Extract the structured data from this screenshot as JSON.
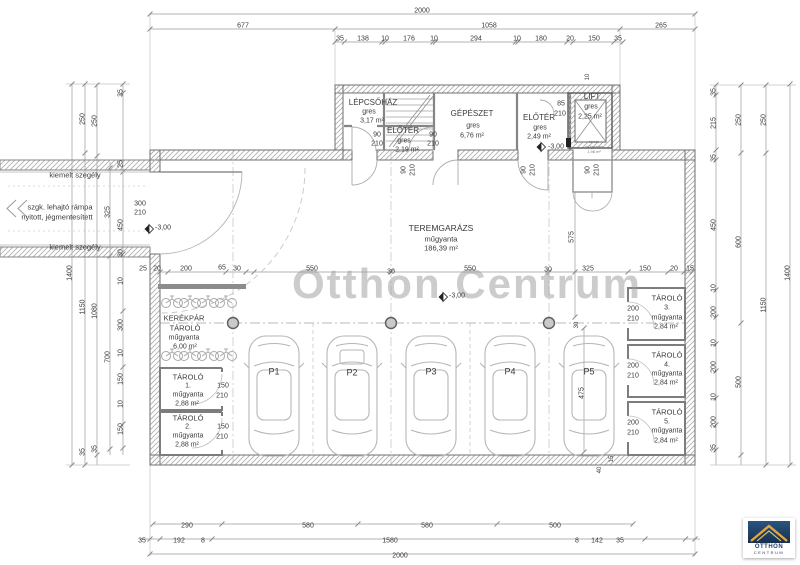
{
  "watermark": {
    "text": "Otthon Centrum",
    "color": "#9b9b9b"
  },
  "logo": {
    "line1": "OTTHON",
    "line2": "CENTRUM",
    "navy": "#1e3f66",
    "gold": "#e8a33d"
  },
  "labels": [
    {
      "t": "2000",
      "x": 422,
      "y": 11
    },
    {
      "t": "677",
      "x": 243,
      "y": 26
    },
    {
      "t": "1058",
      "x": 489,
      "y": 26
    },
    {
      "t": "265",
      "x": 661,
      "y": 26
    },
    {
      "t": "35",
      "x": 340,
      "y": 39
    },
    {
      "t": "138",
      "x": 363,
      "y": 39
    },
    {
      "t": "10",
      "x": 385,
      "y": 39
    },
    {
      "t": "176",
      "x": 409,
      "y": 39
    },
    {
      "t": "10",
      "x": 434,
      "y": 39
    },
    {
      "t": "294",
      "x": 476,
      "y": 39
    },
    {
      "t": "10",
      "x": 517,
      "y": 39
    },
    {
      "t": "180",
      "x": 541,
      "y": 39
    },
    {
      "t": "20",
      "x": 570,
      "y": 39
    },
    {
      "t": "150",
      "x": 594,
      "y": 39
    },
    {
      "t": "35",
      "x": 618,
      "y": 39
    },
    {
      "t": "LÉPCSŐHÁZ",
      "x": 373,
      "y": 103,
      "s": 8,
      "n": "room-label-lepcsohaz"
    },
    {
      "t": "gres",
      "x": 369,
      "y": 112
    },
    {
      "t": "3,17 m²",
      "x": 372,
      "y": 121
    },
    {
      "t": "90",
      "x": 377,
      "y": 135,
      "n": "door-size-label"
    },
    {
      "t": "210",
      "x": 377,
      "y": 144,
      "n": "door-size-label"
    },
    {
      "t": "ELŐTÉR",
      "x": 403,
      "y": 131,
      "s": 8,
      "n": "room-label-eloter-1"
    },
    {
      "t": "gres",
      "x": 404,
      "y": 141
    },
    {
      "t": "2,19 m²",
      "x": 407,
      "y": 150
    },
    {
      "t": "90",
      "x": 433,
      "y": 135,
      "n": "door-size-label"
    },
    {
      "t": "210",
      "x": 433,
      "y": 144,
      "n": "door-size-label"
    },
    {
      "t": "GÉPÉSZET",
      "x": 472,
      "y": 114,
      "s": 8,
      "n": "room-label-gepeszet"
    },
    {
      "t": "gres",
      "x": 473,
      "y": 126
    },
    {
      "t": "6,76 m²",
      "x": 472,
      "y": 136
    },
    {
      "t": "ELŐTÉR",
      "x": 539,
      "y": 118,
      "s": 8,
      "n": "room-label-eloter-2"
    },
    {
      "t": "gres",
      "x": 540,
      "y": 128
    },
    {
      "t": "2,49 m²",
      "x": 539,
      "y": 137
    },
    {
      "t": "-3,00",
      "x": 556,
      "y": 147,
      "n": "level-label"
    },
    {
      "t": "85",
      "x": 561,
      "y": 104,
      "n": "door-size-label"
    },
    {
      "t": "210",
      "x": 560,
      "y": 114,
      "n": "door-size-label"
    },
    {
      "t": "LIFT",
      "x": 592,
      "y": 97,
      "s": 8,
      "n": "room-label-lift"
    },
    {
      "t": "gres",
      "x": 591,
      "y": 107
    },
    {
      "t": "2,25 m²",
      "x": 590,
      "y": 117
    },
    {
      "t": "10",
      "x": 588,
      "y": 77,
      "r": -90,
      "s": 6
    },
    {
      "t": "tároló",
      "x": 594,
      "y": 142,
      "s": 4,
      "c": "#777"
    },
    {
      "t": "műgyanta",
      "x": 594,
      "y": 147,
      "s": 4,
      "c": "#777"
    },
    {
      "t": "1,98 m²",
      "x": 594,
      "y": 152,
      "s": 4,
      "c": "#777"
    },
    {
      "t": "90",
      "x": 404,
      "y": 170,
      "r": -90,
      "n": "door-size-label"
    },
    {
      "t": "210",
      "x": 413,
      "y": 170,
      "r": -90,
      "n": "door-size-label"
    },
    {
      "t": "90",
      "x": 524,
      "y": 170,
      "r": -90,
      "n": "door-size-label"
    },
    {
      "t": "210",
      "x": 533,
      "y": 170,
      "r": -90,
      "n": "door-size-label"
    },
    {
      "t": "90",
      "x": 588,
      "y": 170,
      "r": -90,
      "n": "door-size-label"
    },
    {
      "t": "210",
      "x": 597,
      "y": 170,
      "r": -90,
      "n": "door-size-label"
    },
    {
      "t": "kiemelt szegély",
      "x": 75,
      "y": 175,
      "s": 7.5,
      "n": "annotation-label"
    },
    {
      "t": "szgk. lehajtó rámpa",
      "x": 60,
      "y": 207,
      "s": 7.5,
      "n": "annotation-label"
    },
    {
      "t": "nyitott, jégmentesített",
      "x": 57,
      "y": 217,
      "s": 7.5,
      "n": "annotation-label"
    },
    {
      "t": "kiemelt szegély",
      "x": 75,
      "y": 247,
      "s": 7.5,
      "n": "annotation-label"
    },
    {
      "t": "300",
      "x": 140,
      "y": 204,
      "n": "door-size-label"
    },
    {
      "t": "210",
      "x": 140,
      "y": 213,
      "n": "door-size-label"
    },
    {
      "t": "-3,00",
      "x": 163,
      "y": 228,
      "n": "level-label"
    },
    {
      "t": "1400",
      "x": 70,
      "y": 273,
      "r": -90
    },
    {
      "t": "250",
      "x": 83,
      "y": 119,
      "r": -90
    },
    {
      "t": "1150",
      "x": 83,
      "y": 307,
      "r": -90
    },
    {
      "t": "35",
      "x": 83,
      "y": 452,
      "r": -90
    },
    {
      "t": "250",
      "x": 95,
      "y": 121,
      "r": -90
    },
    {
      "t": "1080",
      "x": 95,
      "y": 311,
      "r": -90
    },
    {
      "t": "35",
      "x": 95,
      "y": 449,
      "r": -90
    },
    {
      "t": "325",
      "x": 108,
      "y": 212,
      "r": -90
    },
    {
      "t": "700",
      "x": 108,
      "y": 357,
      "r": -90
    },
    {
      "t": "35",
      "x": 121,
      "y": 93,
      "r": -90
    },
    {
      "t": "25",
      "x": 121,
      "y": 164,
      "r": -90
    },
    {
      "t": "450",
      "x": 121,
      "y": 225,
      "r": -90
    },
    {
      "t": "30",
      "x": 121,
      "y": 253,
      "r": -90
    },
    {
      "t": "10",
      "x": 121,
      "y": 281,
      "r": -90
    },
    {
      "t": "300",
      "x": 121,
      "y": 325,
      "r": -90
    },
    {
      "t": "10",
      "x": 121,
      "y": 353,
      "r": -90
    },
    {
      "t": "150",
      "x": 121,
      "y": 379,
      "r": -90
    },
    {
      "t": "10",
      "x": 121,
      "y": 404,
      "r": -90
    },
    {
      "t": "150",
      "x": 121,
      "y": 429,
      "r": -90
    },
    {
      "t": "35",
      "x": 714,
      "y": 92,
      "r": -90
    },
    {
      "t": "215",
      "x": 714,
      "y": 123,
      "r": -90
    },
    {
      "t": "35",
      "x": 714,
      "y": 158,
      "r": -90
    },
    {
      "t": "450",
      "x": 714,
      "y": 225,
      "r": -90
    },
    {
      "t": "10",
      "x": 714,
      "y": 288,
      "r": -90
    },
    {
      "t": "200",
      "x": 714,
      "y": 312,
      "r": -90
    },
    {
      "t": "10",
      "x": 714,
      "y": 343,
      "r": -90
    },
    {
      "t": "200",
      "x": 714,
      "y": 367,
      "r": -90
    },
    {
      "t": "10",
      "x": 714,
      "y": 397,
      "r": -90
    },
    {
      "t": "200",
      "x": 714,
      "y": 422,
      "r": -90
    },
    {
      "t": "35",
      "x": 714,
      "y": 448,
      "r": -90
    },
    {
      "t": "250",
      "x": 739,
      "y": 120,
      "r": -90
    },
    {
      "t": "600",
      "x": 739,
      "y": 242,
      "r": -90
    },
    {
      "t": "500",
      "x": 739,
      "y": 382,
      "r": -90
    },
    {
      "t": "250",
      "x": 764,
      "y": 120,
      "r": -90
    },
    {
      "t": "1150",
      "x": 764,
      "y": 305,
      "r": -90
    },
    {
      "t": "1400",
      "x": 788,
      "y": 273,
      "r": -90
    },
    {
      "t": "25",
      "x": 143,
      "y": 269
    },
    {
      "t": "20",
      "x": 157,
      "y": 269
    },
    {
      "t": "200",
      "x": 186,
      "y": 269
    },
    {
      "t": "65",
      "x": 222,
      "y": 268
    },
    {
      "t": "30",
      "x": 237,
      "y": 269
    },
    {
      "t": "550",
      "x": 312,
      "y": 269
    },
    {
      "t": "30",
      "x": 391,
      "y": 272
    },
    {
      "t": "550",
      "x": 470,
      "y": 269
    },
    {
      "t": "30",
      "x": 548,
      "y": 270
    },
    {
      "t": "325",
      "x": 588,
      "y": 269
    },
    {
      "t": "150",
      "x": 645,
      "y": 269
    },
    {
      "t": "20",
      "x": 674,
      "y": 269
    },
    {
      "t": "15",
      "x": 690,
      "y": 269
    },
    {
      "t": "575",
      "x": 572,
      "y": 237,
      "r": -90
    },
    {
      "t": "30",
      "x": 577,
      "y": 325,
      "r": -90,
      "s": 6
    },
    {
      "t": "475",
      "x": 582,
      "y": 393,
      "r": -90
    },
    {
      "t": "15",
      "x": 612,
      "y": 459,
      "r": -90,
      "s": 6
    },
    {
      "t": "40",
      "x": 600,
      "y": 470,
      "r": -90,
      "s": 6
    },
    {
      "t": "TEREMGARÁZS",
      "x": 441,
      "y": 228,
      "s": 8.5,
      "n": "room-label-teremgaraz"
    },
    {
      "t": "műgyanta",
      "x": 441,
      "y": 239,
      "s": 7.5
    },
    {
      "t": "186,39 m²",
      "x": 441,
      "y": 248,
      "s": 7.5
    },
    {
      "t": "-3,00",
      "x": 457,
      "y": 296,
      "n": "level-label"
    },
    {
      "t": "KERÉKPÁR",
      "x": 184,
      "y": 318,
      "s": 7.5,
      "n": "room-label-kerekpar-tarolo"
    },
    {
      "t": "TÁROLÓ",
      "x": 185,
      "y": 328,
      "s": 7.5
    },
    {
      "t": "műgyanta",
      "x": 184,
      "y": 338
    },
    {
      "t": "6,00 m²",
      "x": 185,
      "y": 347
    },
    {
      "t": "TÁROLÓ",
      "x": 188,
      "y": 377,
      "s": 7.5,
      "n": "room-label-tarolo-1"
    },
    {
      "t": "1.",
      "x": 188,
      "y": 386
    },
    {
      "t": "műgyanta",
      "x": 188,
      "y": 395
    },
    {
      "t": "2,88 m²",
      "x": 187,
      "y": 404
    },
    {
      "t": "150",
      "x": 223,
      "y": 386,
      "n": "door-size-label"
    },
    {
      "t": "210",
      "x": 222,
      "y": 396,
      "n": "door-size-label"
    },
    {
      "t": "TÁROLÓ",
      "x": 188,
      "y": 418,
      "s": 7.5,
      "n": "room-label-tarolo-2"
    },
    {
      "t": "2.",
      "x": 188,
      "y": 427
    },
    {
      "t": "műgyanta",
      "x": 188,
      "y": 436
    },
    {
      "t": "2,88 m²",
      "x": 187,
      "y": 445
    },
    {
      "t": "150",
      "x": 223,
      "y": 427,
      "n": "door-size-label"
    },
    {
      "t": "210",
      "x": 222,
      "y": 437,
      "n": "door-size-label"
    },
    {
      "t": "TÁROLÓ",
      "x": 667,
      "y": 298,
      "s": 7.5,
      "n": "room-label-tarolo-3"
    },
    {
      "t": "3.",
      "x": 667,
      "y": 308
    },
    {
      "t": "műgyanta",
      "x": 667,
      "y": 318
    },
    {
      "t": "2,84 m²",
      "x": 666,
      "y": 327
    },
    {
      "t": "200",
      "x": 633,
      "y": 309,
      "n": "door-size-label"
    },
    {
      "t": "210",
      "x": 633,
      "y": 319,
      "n": "door-size-label"
    },
    {
      "t": "TÁROLÓ",
      "x": 667,
      "y": 355,
      "s": 7.5,
      "n": "room-label-tarolo-4"
    },
    {
      "t": "4.",
      "x": 667,
      "y": 365
    },
    {
      "t": "műgyanta",
      "x": 667,
      "y": 374
    },
    {
      "t": "2,84 m²",
      "x": 666,
      "y": 383
    },
    {
      "t": "200",
      "x": 633,
      "y": 366,
      "n": "door-size-label"
    },
    {
      "t": "210",
      "x": 633,
      "y": 376,
      "n": "door-size-label"
    },
    {
      "t": "TÁROLÓ",
      "x": 667,
      "y": 412,
      "s": 7.5,
      "n": "room-label-tarolo-5"
    },
    {
      "t": "5.",
      "x": 667,
      "y": 422
    },
    {
      "t": "műgyanta",
      "x": 667,
      "y": 431
    },
    {
      "t": "2,84 m²",
      "x": 666,
      "y": 441
    },
    {
      "t": "200",
      "x": 633,
      "y": 423,
      "n": "door-size-label"
    },
    {
      "t": "210",
      "x": 633,
      "y": 433,
      "n": "door-size-label"
    },
    {
      "t": "P1",
      "x": 274,
      "y": 372,
      "s": 9,
      "n": "parking-stall-label"
    },
    {
      "t": "P2",
      "x": 352,
      "y": 373,
      "s": 9,
      "n": "parking-stall-label"
    },
    {
      "t": "P3",
      "x": 431,
      "y": 372,
      "s": 9,
      "n": "parking-stall-label"
    },
    {
      "t": "P4",
      "x": 510,
      "y": 372,
      "s": 9,
      "n": "parking-stall-label"
    },
    {
      "t": "P5",
      "x": 589,
      "y": 372,
      "s": 9,
      "n": "parking-stall-label"
    },
    {
      "t": "290",
      "x": 187,
      "y": 526
    },
    {
      "t": "580",
      "x": 308,
      "y": 526
    },
    {
      "t": "580",
      "x": 427,
      "y": 526
    },
    {
      "t": "500",
      "x": 555,
      "y": 526
    },
    {
      "t": "35",
      "x": 142,
      "y": 541
    },
    {
      "t": "192",
      "x": 179,
      "y": 541
    },
    {
      "t": "8",
      "x": 203,
      "y": 541
    },
    {
      "t": "1580",
      "x": 390,
      "y": 541
    },
    {
      "t": "8",
      "x": 577,
      "y": 541
    },
    {
      "t": "142",
      "x": 597,
      "y": 541
    },
    {
      "t": "35",
      "x": 620,
      "y": 541
    },
    {
      "t": "2000",
      "x": 400,
      "y": 556
    }
  ]
}
